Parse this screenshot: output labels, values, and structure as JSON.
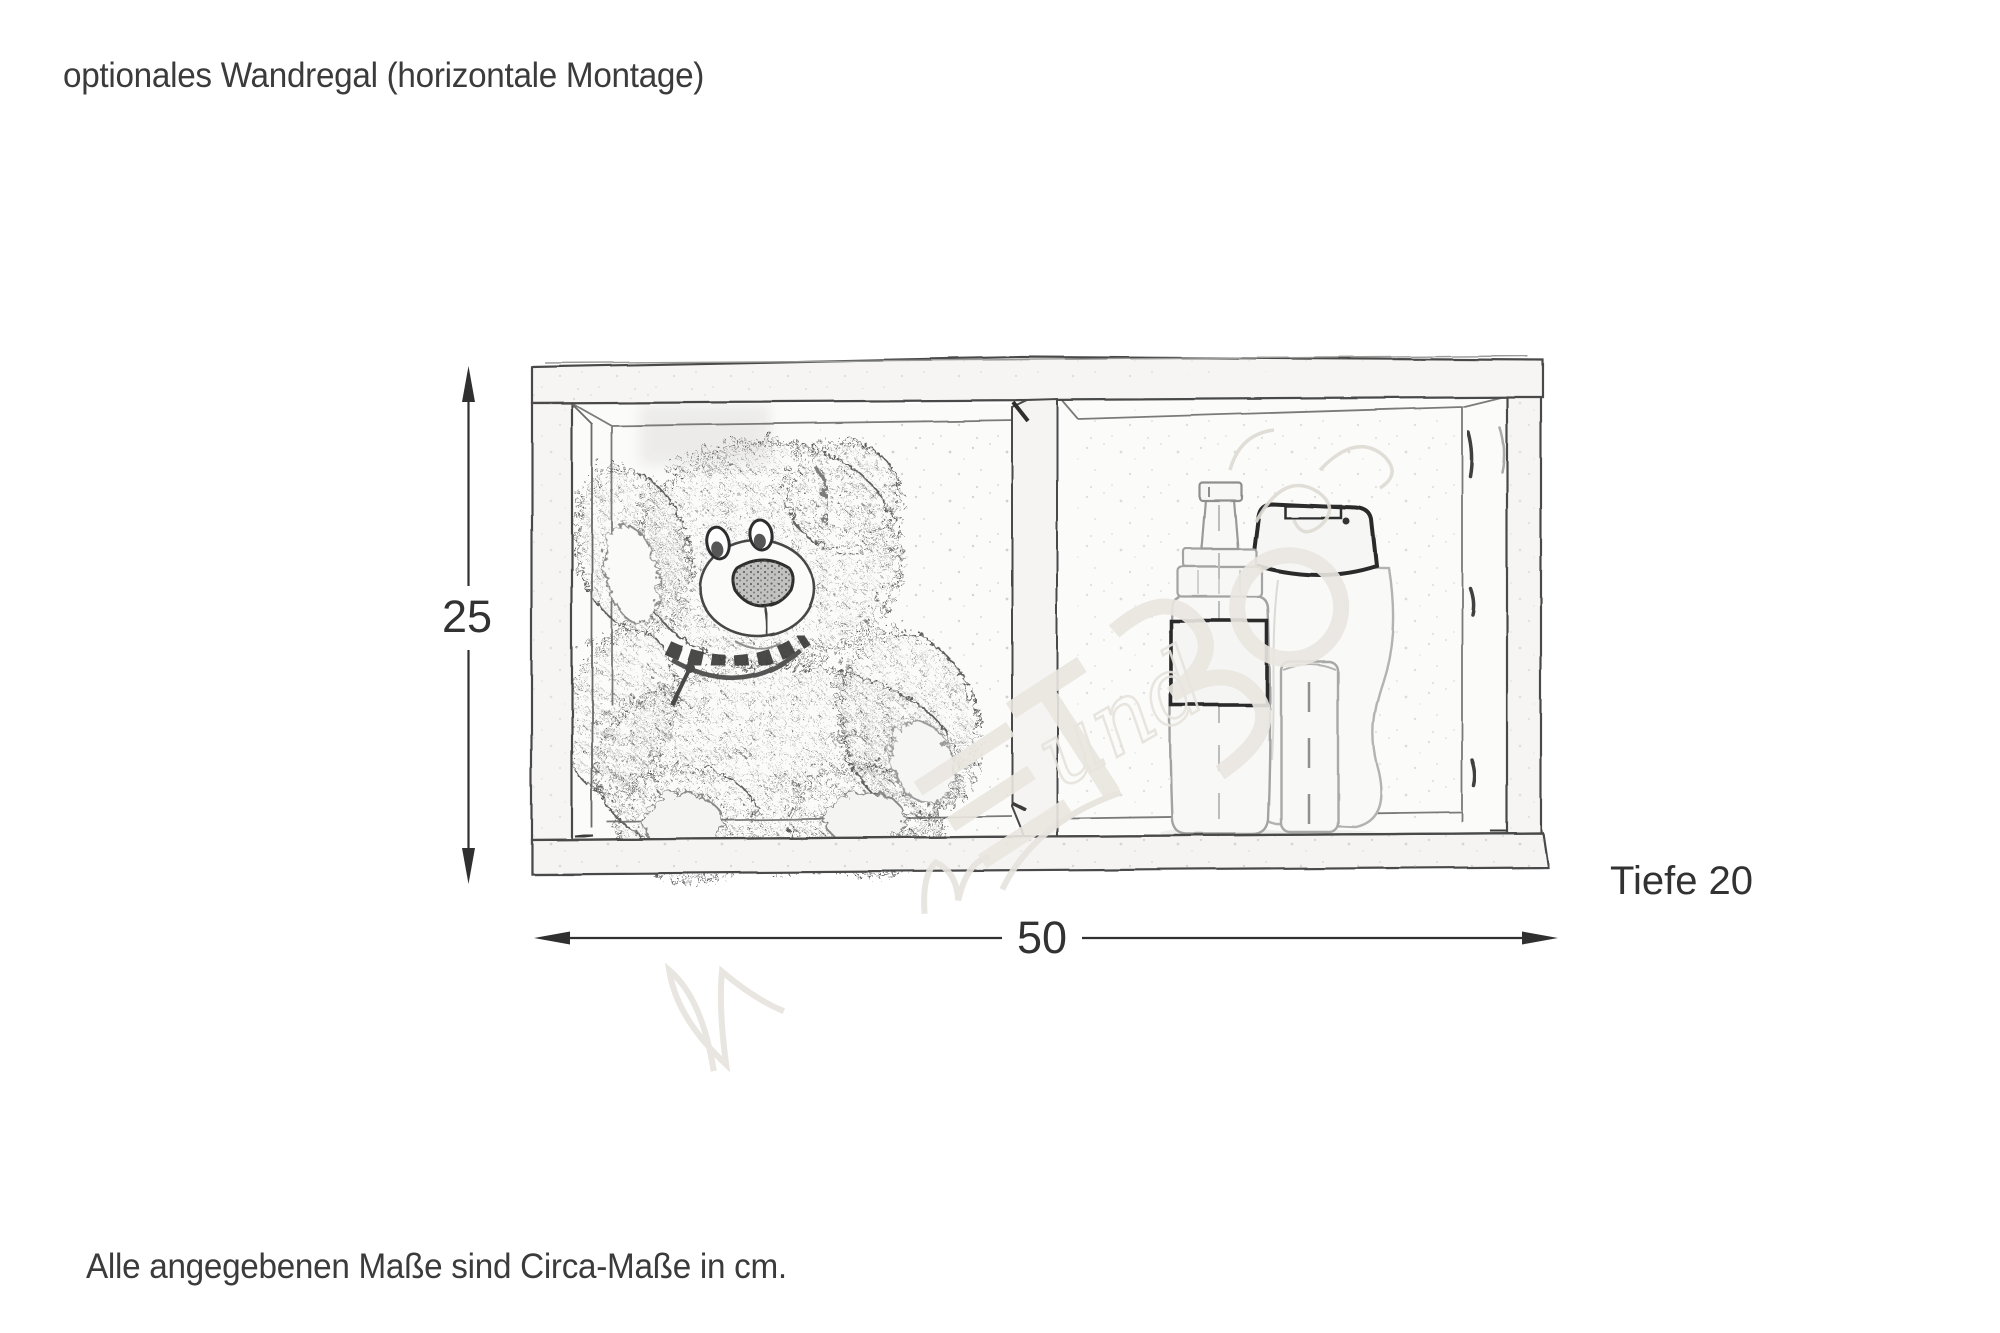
{
  "page": {
    "title": "optionales Wandregal (horizontale Montage)",
    "footnote": "Alle angegebenen Maße sind Circa-Maße in cm."
  },
  "diagram": {
    "type": "furniture-dimension-sketch",
    "subject": "Wandregal mit zwei Fächern (Skizze), horizontale Montage",
    "dimensions": {
      "height_cm": "25",
      "width_cm": "50",
      "depth_label": "Tiefe 20"
    },
    "unit": "cm",
    "contents": [
      "teddy-bear-sketch",
      "foam-pump-bottle-sketch",
      "shampoo-bottle-sketch",
      "small-cylinder-bottle-sketch"
    ],
    "watermark_script_fragment": "und",
    "colors": {
      "line": "#4a4a4a",
      "dark_accent": "#2c2c2c",
      "dimension_text": "#323232",
      "paper": "#ffffff",
      "watermark": "#e9e5df"
    }
  }
}
